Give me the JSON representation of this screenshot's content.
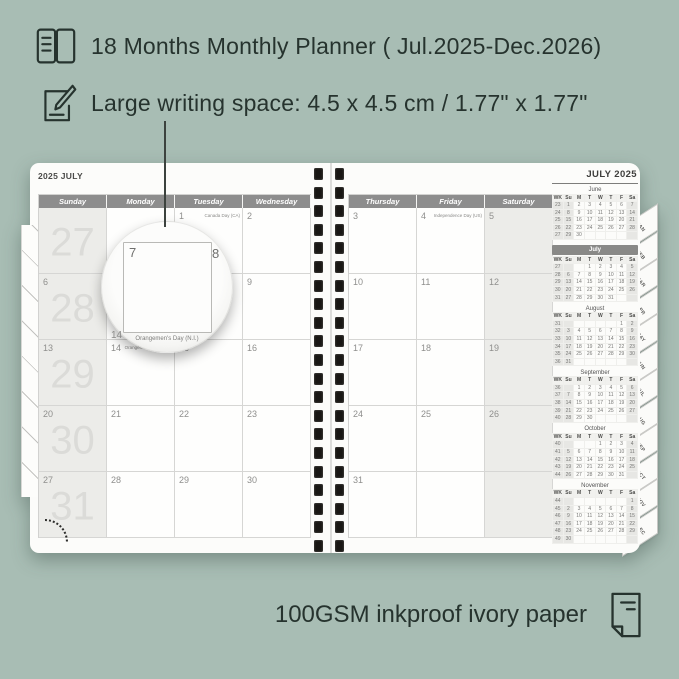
{
  "colors": {
    "background": "#a8bdb4",
    "ink": "#26332e",
    "header_bar": "#8d8d8d",
    "shade": "#ecece9",
    "watermark": "#dbdbd8",
    "page": "#fcfcfa"
  },
  "feature1": {
    "text": "18 Months Monthly Planner ( Jul.2025-Dec.2026)",
    "icon": "notebook-icon"
  },
  "feature2": {
    "text": "Large writing space: 4.5 x 4.5 cm / 1.77\" x 1.77\"",
    "icon": "pencil-note-icon"
  },
  "footer": {
    "text": "100GSM inkproof ivory paper",
    "icon": "paper-sheet-icon"
  },
  "magnifier": {
    "day": "7",
    "next_day": "8",
    "below_day": "14",
    "holiday": "Orangemen's Day (N.I.)"
  },
  "planner": {
    "left_page": {
      "title": "2025 JULY",
      "day_headers": [
        "Sunday",
        "Monday",
        "Tuesday",
        "Wednesday"
      ],
      "week_watermarks": [
        "27",
        "28",
        "29",
        "30",
        "31"
      ],
      "rows": [
        [
          {
            "date": ""
          },
          {
            "date": ""
          },
          {
            "date": "1",
            "holiday": "Canada Day (CA)"
          },
          {
            "date": "2"
          }
        ],
        [
          {
            "date": "6"
          },
          {
            "date": "7"
          },
          {
            "date": "8"
          },
          {
            "date": "9"
          }
        ],
        [
          {
            "date": "13"
          },
          {
            "date": "14",
            "holiday": "Orangemen's Day (N.I.)"
          },
          {
            "date": "15"
          },
          {
            "date": "16"
          }
        ],
        [
          {
            "date": "20"
          },
          {
            "date": "21"
          },
          {
            "date": "22"
          },
          {
            "date": "23"
          }
        ],
        [
          {
            "date": "27"
          },
          {
            "date": "28"
          },
          {
            "date": "29"
          },
          {
            "date": "30"
          }
        ]
      ]
    },
    "right_page": {
      "title": "JULY 2025",
      "day_headers": [
        "Thursday",
        "Friday",
        "Saturday"
      ],
      "rows": [
        [
          {
            "date": "3"
          },
          {
            "date": "4",
            "holiday": "Independence Day (US)"
          },
          {
            "date": "5"
          }
        ],
        [
          {
            "date": "10"
          },
          {
            "date": "11"
          },
          {
            "date": "12"
          }
        ],
        [
          {
            "date": "17"
          },
          {
            "date": "18"
          },
          {
            "date": "19"
          }
        ],
        [
          {
            "date": "24"
          },
          {
            "date": "25"
          },
          {
            "date": "26"
          }
        ],
        [
          {
            "date": "31"
          },
          {
            "date": ""
          },
          {
            "date": ""
          }
        ]
      ]
    },
    "mini_calendars": [
      {
        "name": "June",
        "highlight": false,
        "cols": [
          "WK",
          "Su",
          "M",
          "T",
          "W",
          "T",
          "F",
          "Sa"
        ],
        "rows": [
          [
            "23",
            "1",
            "2",
            "3",
            "4",
            "5",
            "6",
            "7"
          ],
          [
            "24",
            "8",
            "9",
            "10",
            "11",
            "12",
            "13",
            "14"
          ],
          [
            "25",
            "15",
            "16",
            "17",
            "18",
            "19",
            "20",
            "21"
          ],
          [
            "26",
            "22",
            "23",
            "24",
            "25",
            "26",
            "27",
            "28"
          ],
          [
            "27",
            "29",
            "30",
            "",
            "",
            "",
            "",
            ""
          ]
        ]
      },
      {
        "name": "July",
        "highlight": true,
        "cols": [
          "WK",
          "Su",
          "M",
          "T",
          "W",
          "T",
          "F",
          "Sa"
        ],
        "rows": [
          [
            "27",
            "",
            "",
            "1",
            "2",
            "3",
            "4",
            "5"
          ],
          [
            "28",
            "6",
            "7",
            "8",
            "9",
            "10",
            "11",
            "12"
          ],
          [
            "29",
            "13",
            "14",
            "15",
            "16",
            "17",
            "18",
            "19"
          ],
          [
            "30",
            "20",
            "21",
            "22",
            "23",
            "24",
            "25",
            "26"
          ],
          [
            "31",
            "27",
            "28",
            "29",
            "30",
            "31",
            "",
            ""
          ]
        ]
      },
      {
        "name": "August",
        "highlight": false,
        "cols": [
          "WK",
          "Su",
          "M",
          "T",
          "W",
          "T",
          "F",
          "Sa"
        ],
        "rows": [
          [
            "31",
            "",
            "",
            "",
            "",
            "",
            "1",
            "2"
          ],
          [
            "32",
            "3",
            "4",
            "5",
            "6",
            "7",
            "8",
            "9"
          ],
          [
            "33",
            "10",
            "11",
            "12",
            "13",
            "14",
            "15",
            "16"
          ],
          [
            "34",
            "17",
            "18",
            "19",
            "20",
            "21",
            "22",
            "23"
          ],
          [
            "35",
            "24",
            "25",
            "26",
            "27",
            "28",
            "29",
            "30"
          ],
          [
            "36",
            "31",
            "",
            "",
            "",
            "",
            "",
            ""
          ]
        ]
      },
      {
        "name": "September",
        "highlight": false,
        "cols": [
          "WK",
          "Su",
          "M",
          "T",
          "W",
          "T",
          "F",
          "Sa"
        ],
        "rows": [
          [
            "36",
            "",
            "1",
            "2",
            "3",
            "4",
            "5",
            "6"
          ],
          [
            "37",
            "7",
            "8",
            "9",
            "10",
            "11",
            "12",
            "13"
          ],
          [
            "38",
            "14",
            "15",
            "16",
            "17",
            "18",
            "19",
            "20"
          ],
          [
            "39",
            "21",
            "22",
            "23",
            "24",
            "25",
            "26",
            "27"
          ],
          [
            "40",
            "28",
            "29",
            "30",
            "",
            "",
            "",
            ""
          ]
        ]
      },
      {
        "name": "October",
        "highlight": false,
        "cols": [
          "WK",
          "Su",
          "M",
          "T",
          "W",
          "T",
          "F",
          "Sa"
        ],
        "rows": [
          [
            "40",
            "",
            "",
            "",
            "1",
            "2",
            "3",
            "4"
          ],
          [
            "41",
            "5",
            "6",
            "7",
            "8",
            "9",
            "10",
            "11"
          ],
          [
            "42",
            "12",
            "13",
            "14",
            "15",
            "16",
            "17",
            "18"
          ],
          [
            "43",
            "19",
            "20",
            "21",
            "22",
            "23",
            "24",
            "25"
          ],
          [
            "44",
            "26",
            "27",
            "28",
            "29",
            "30",
            "31",
            ""
          ]
        ]
      },
      {
        "name": "November",
        "highlight": false,
        "cols": [
          "WK",
          "Su",
          "M",
          "T",
          "W",
          "T",
          "F",
          "Sa"
        ],
        "rows": [
          [
            "44",
            "",
            "",
            "",
            "",
            "",
            "",
            "1"
          ],
          [
            "45",
            "2",
            "3",
            "4",
            "5",
            "6",
            "7",
            "8"
          ],
          [
            "46",
            "9",
            "10",
            "11",
            "12",
            "13",
            "14",
            "15"
          ],
          [
            "47",
            "16",
            "17",
            "18",
            "19",
            "20",
            "21",
            "22"
          ],
          [
            "48",
            "23",
            "24",
            "25",
            "26",
            "27",
            "28",
            "29"
          ],
          [
            "49",
            "30",
            "",
            "",
            "",
            "",
            "",
            ""
          ]
        ]
      }
    ],
    "month_tabs": [
      "JAN",
      "FEB",
      "MAR",
      "APR",
      "MAY",
      "JUN",
      "JUL",
      "AUG",
      "SEP",
      "OCT",
      "NOV",
      "DEC"
    ]
  }
}
